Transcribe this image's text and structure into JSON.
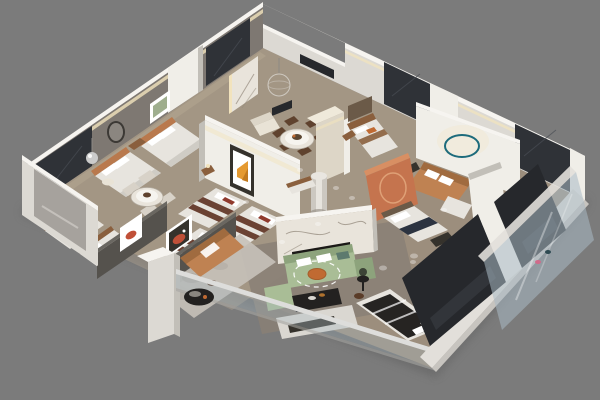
{
  "meta": {
    "type": "3d-axonometric-floorplan-render",
    "description": "Photoreal cutaway dollhouse render of a furnished multi-room apartment / bedding showroom viewed from above at an angle, floating on a plain gray backdrop. No text or UI elements are visible.",
    "visible_zones": 10
  },
  "colors": {
    "bg": "#7b7b7b",
    "shadow": "#5e5e5e",
    "floor_main": "#9c8e7d",
    "floor_light": "#ae9f8d",
    "floor_living": "#8a8075",
    "wall_white": "#dcd9d3",
    "wall_gray": "#7e7872",
    "wall_bright": "#f0eee8",
    "wall_cap": "#f6f4f0",
    "wall_shade": "#c2bfb8",
    "wall_dark": "#55524d",
    "wall_dark_cap": "#6a6761",
    "led_warm": "#f2e3bd",
    "panel_dark": "#2f3237",
    "panel_dark2": "#26282c",
    "panel_streak": "#4a4e55",
    "slab_streak": "#3d4147",
    "marble_light": "#e9e4db",
    "marble_inner": "#f6f4ef",
    "marble_vein": "#93897c",
    "wood_brown": "#8a5f3d",
    "headboard_orange": "#b9794d",
    "hb_panel": "#6b5a48",
    "bed_white": "#e7e4de",
    "bed_shadow": "#cfccc5",
    "stripe_maroon": "#6b4233",
    "pillow_red": "#8f3a2d",
    "pillow_orange": "#c06a32",
    "throw_navy": "#2c3340",
    "bed_dark": "#262422",
    "bed_gray": "#c9c5be",
    "bed_gray_stripe": "#b1ada6",
    "sofa_green": "#a9bd96",
    "sofa_green_dark": "#8da37c",
    "cushion_teal": "#5d7a6e",
    "sofa_caramel": "#bf8252",
    "caramel_dark": "#a06b3f",
    "table_black": "#232120",
    "console_white": "#dad7d1",
    "frame_dark": "#35322c",
    "art_orange": "#e59a31",
    "art_orange_deep": "#c27a1f",
    "art_green": "#9fae8e",
    "accent_teal": "#2f8fa2",
    "teal_ring": "#1d6b7c",
    "terracotta": "#c5744e",
    "terracotta_light": "#d88f63",
    "arch_inner": "#6e3526",
    "arch_ring": "#dfa076",
    "chair_brown": "#5f422e",
    "chair_cream": "#d8d2c8",
    "rug_marble": "#c6c1b9",
    "rug_mottle": "#a7a29a",
    "chrome_silver": "#cbcbcb",
    "art_red": "#c05038",
    "slat_wood": "#7a6248",
    "slat_line": "#c9ae84",
    "glass_blue": "#a9bac4",
    "glass_pink": "#d06a8a",
    "glass_teal": "#2e4a52",
    "band_white": "#e2dfda",
    "band_edge": "#c7c4bf",
    "rail_light": "#dddddb",
    "rail_dark": "#a5a5a2",
    "insert_gray": "#a29f9a",
    "column_beige": "#ddd6c7",
    "column_top": "#efe9da",
    "cream": "#e9e3d6",
    "cream_dark": "#ddd6c8",
    "plant_green": "#3c4436",
    "stool_brown": "#5a3c28",
    "tv_black": "#1b1917",
    "cyl_body": "#ccc8c1",
    "cyl_hi": "#e7e4de",
    "pend_line": "#d3cec6",
    "metal_gray": "#8d8a85",
    "white": "#ffffff"
  },
  "scene": {
    "rooms": [
      {
        "id": "bedroom-top-left",
        "furniture": [
          "double-bed-orange-headboard",
          "double-bed-orange-headboard",
          "round-mirror",
          "green-window-art",
          "nightstand",
          "dark-window-panels"
        ]
      },
      {
        "id": "dining-nook-left",
        "furniture": [
          "round-marble-table",
          "four-cream-chairs"
        ]
      },
      {
        "id": "bedroom-lower-left",
        "furniture": [
          "gray-bed",
          "gray-bed",
          "white-art-red-oval",
          "dark-partition-wall"
        ]
      },
      {
        "id": "bedding-display-center",
        "furniture": [
          "white-display-wall",
          "orange-abstract-art",
          "striped-maroon-bed",
          "striped-maroon-bed",
          "striped-maroon-bed"
        ]
      },
      {
        "id": "entry-hall",
        "furniture": [
          "marble-slab",
          "wire-pendant-lamp",
          "cream-loveseat",
          "wall-tv"
        ]
      },
      {
        "id": "dining-room-center",
        "furniture": [
          "round-white-table",
          "six-walnut-chairs",
          "beige-column",
          "white-cylinder-column",
          "sideboard"
        ]
      },
      {
        "id": "bedroom-top-center",
        "furniture": [
          "bed-brown-band",
          "headboard-panel",
          "nightstand"
        ]
      },
      {
        "id": "teal-accent-room",
        "furniture": [
          "teal-circle-wall",
          "caramel-daybed",
          "white-chaise"
        ]
      },
      {
        "id": "arch-room",
        "furniture": [
          "terracotta-arch-partition",
          "white-bed-navy-throw",
          "bench"
        ]
      },
      {
        "id": "corner-bedroom-right",
        "furniture": [
          "white-cabinet",
          "gray-mattress-bed",
          "slatted-screen",
          "glass-facade"
        ]
      },
      {
        "id": "living-room-center",
        "furniture": [
          "marble-tv-wall",
          "green-sectional-sofa",
          "ring-light",
          "orange-cushion",
          "black-coffee-table",
          "white-media-console",
          "side-table-plant"
        ]
      },
      {
        "id": "lounge-bottom-left",
        "furniture": [
          "caramel-sofa",
          "black-round-table",
          "marble-rug",
          "framed-red-art",
          "white-pillar",
          "glass-railing"
        ]
      },
      {
        "id": "bedroom-bottom-right",
        "furniture": [
          "dark-bed-white-stripes",
          "dark-glass-slabs"
        ]
      }
    ]
  }
}
